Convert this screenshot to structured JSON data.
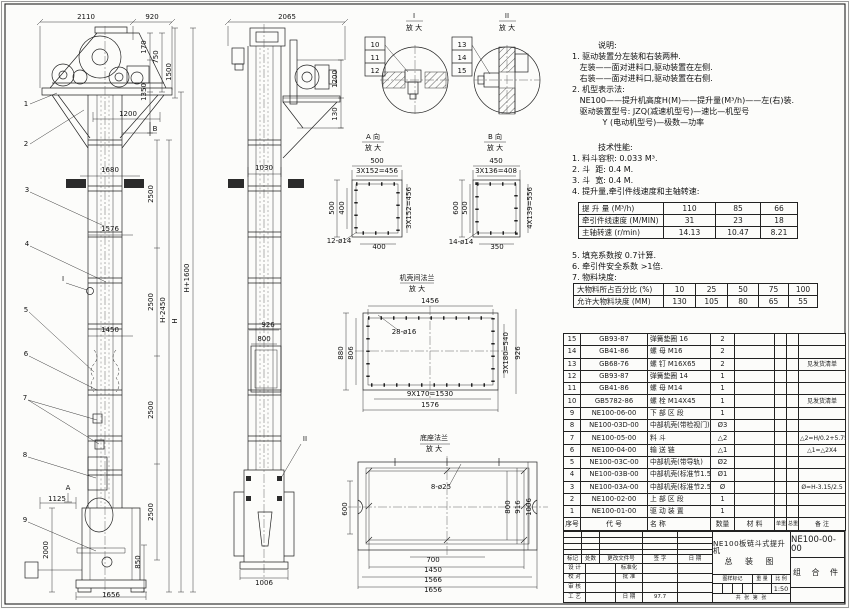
{
  "colors": {
    "paper": "#fcfcfa",
    "ink": "#222222"
  },
  "notes": {
    "heading": "说明:",
    "lines": [
      "1. 驱动装置分左装和右装两种.",
      "   左装——面对进料口,驱动装置在左侧.",
      "   右装——面对进料口,驱动装置在右侧.",
      "2. 机型表示法:",
      "   NE100——提升机高度H(M)——提升量(M³/h)——左(右)装.",
      "   驱动装置型号: JZQ(减速机型号)—速比—机型号",
      "            Y (电动机型号)—极数—功率"
    ]
  },
  "tech": {
    "heading": "技术性能:",
    "lines": [
      "1. 料斗容积: 0.033 M³.",
      "2. 斗  距: 0.4 M.",
      "3. 斗  宽: 0.4 M.",
      "4. 提升量,牵引件线速度和主轴转速:"
    ],
    "table1": [
      [
        "提 升 量 (M³/h)",
        "110",
        "85",
        "66"
      ],
      [
        "牵引件线速度 (M/MIN)",
        "31",
        "23",
        "18"
      ],
      [
        "主轴转速 (r/min)",
        "14.13",
        "10.47",
        "8.21"
      ]
    ],
    "lines2": [
      "5. 填充系数按 0.7计算.",
      "6. 牵引件安全系数 >1倍.",
      "7. 物料块度:"
    ],
    "table2": [
      [
        "大物料所占百分比 (%)",
        "10",
        "25",
        "50",
        "75",
        "100"
      ],
      [
        "允许大物料块度 (MM)",
        "130",
        "105",
        "80",
        "65",
        "55"
      ]
    ]
  },
  "parts": {
    "grid": [
      [
        "15",
        "GB93-87",
        "弹簧垫圈 16",
        "2",
        "",
        "",
        "",
        ""
      ],
      [
        "14",
        "GB41-86",
        "螺 母 M16",
        "2",
        "",
        "",
        "",
        ""
      ],
      [
        "13",
        "GB68-76",
        "螺 钉 M16X65",
        "2",
        "",
        "",
        "",
        "见发货清单"
      ],
      [
        "12",
        "GB93-87",
        "弹簧垫圈 14",
        "1",
        "",
        "",
        "",
        ""
      ],
      [
        "11",
        "GB41-86",
        "螺 母 M14",
        "1",
        "",
        "",
        "",
        ""
      ],
      [
        "10",
        "GB5782-86",
        "螺 栓 M14X45",
        "1",
        "",
        "",
        "",
        "见发货清单"
      ],
      [
        "9",
        "NE100-06-00",
        "下 部 区 段",
        "1",
        "",
        "",
        "",
        ""
      ],
      [
        "8",
        "NE100-03D-00",
        "中部机壳(带检视门)",
        "Ø3",
        "",
        "",
        "",
        ""
      ],
      [
        "7",
        "NE100-05-00",
        "料 斗",
        "△2",
        "",
        "",
        "",
        "△2=H/0.2+5.75"
      ],
      [
        "6",
        "NE100-04-00",
        "输 送 链",
        "△1",
        "",
        "",
        "",
        "△1=△2X4"
      ],
      [
        "5",
        "NE100-03C-00",
        "中部机壳(带导轨)",
        "Ø2",
        "",
        "",
        "",
        ""
      ],
      [
        "4",
        "NE100-03B-00",
        "中部机壳(标准节1.5M,1M)",
        "Ø1",
        "",
        "",
        "",
        ""
      ],
      [
        "3",
        "NE100-03A-00",
        "中部机壳(标准节2.5M)",
        "Ø",
        "",
        "",
        "",
        "Ø=H-3.15/2.5"
      ],
      [
        "2",
        "NE100-02-00",
        "上 部 区 段",
        "1",
        "",
        "",
        "",
        ""
      ],
      [
        "1",
        "NE100-01-00",
        "驱 动 装 置",
        "1",
        "",
        "",
        "",
        ""
      ],
      [
        "序号",
        "代  号",
        "名    称",
        "数量",
        "材  料",
        "单重",
        "总重",
        "备  注"
      ]
    ]
  },
  "tb": {
    "rev": [
      "标记",
      "处数",
      "更改文件号",
      "签 字",
      "日 期"
    ],
    "sign": [
      {
        "a": "设 计",
        "b": "标准化"
      },
      {
        "a": "校 对",
        "b": "批 准"
      },
      {
        "a": "审 核",
        "b": ""
      },
      {
        "a": "工 艺",
        "b": "日 期"
      }
    ],
    "date": "97.7",
    "title1": "NE100板链斗式提升机",
    "title2": "总 装 图",
    "stamp": [
      "图样标记",
      "重 量",
      "比 例"
    ],
    "scale": "1:50",
    "sheetnote": "共  张 第  张",
    "dno": "NE100-00-00",
    "type": "组 合 件"
  },
  "drawing": {
    "labels": [
      {
        "t": "2110",
        "x": 86,
        "y": 19
      },
      {
        "t": "920",
        "x": 152,
        "y": 19
      },
      {
        "t": "170",
        "x": 146,
        "y": 47,
        "r": -90,
        "s": 6
      },
      {
        "t": "750",
        "x": 158,
        "y": 57,
        "r": -90,
        "s": 6
      },
      {
        "t": "1350",
        "x": 146,
        "y": 92,
        "r": -90,
        "s": 6
      },
      {
        "t": "1500",
        "x": 171,
        "y": 72,
        "r": -90,
        "s": 6
      },
      {
        "t": "1200",
        "x": 128,
        "y": 116
      },
      {
        "t": "B",
        "x": 155,
        "y": 131
      },
      {
        "t": "1680",
        "x": 110,
        "y": 172
      },
      {
        "t": "1576",
        "x": 110,
        "y": 231
      },
      {
        "t": "1450",
        "x": 110,
        "y": 332
      },
      {
        "t": "2500",
        "x": 153,
        "y": 194,
        "r": -90,
        "s": 6
      },
      {
        "t": "2500",
        "x": 153,
        "y": 302,
        "r": -90,
        "s": 6
      },
      {
        "t": "2500",
        "x": 153,
        "y": 410,
        "r": -90,
        "s": 6
      },
      {
        "t": "2500",
        "x": 153,
        "y": 512,
        "r": -90,
        "s": 6
      },
      {
        "t": "H-2450",
        "x": 165,
        "y": 310,
        "r": -90,
        "s": 6
      },
      {
        "t": "H",
        "x": 177,
        "y": 321,
        "r": -90,
        "s": 6
      },
      {
        "t": "H+1600",
        "x": 189,
        "y": 278,
        "r": -90,
        "s": 6
      },
      {
        "t": "I",
        "x": 63,
        "y": 281
      },
      {
        "t": "A",
        "x": 68,
        "y": 490,
        "s": 6.5
      },
      {
        "t": "1125",
        "x": 57,
        "y": 501,
        "s": 6.5
      },
      {
        "t": "2000",
        "x": 48,
        "y": 550,
        "r": -90,
        "s": 6
      },
      {
        "t": "850",
        "x": 140,
        "y": 562,
        "r": -90,
        "s": 6
      },
      {
        "t": "1656",
        "x": 111,
        "y": 597
      },
      {
        "t": "1",
        "x": 26,
        "y": 106
      },
      {
        "t": "2",
        "x": 26,
        "y": 146
      },
      {
        "t": "3",
        "x": 27,
        "y": 192
      },
      {
        "t": "4",
        "x": 27,
        "y": 246
      },
      {
        "t": "5",
        "x": 26,
        "y": 312
      },
      {
        "t": "6",
        "x": 26,
        "y": 356
      },
      {
        "t": "7",
        "x": 25,
        "y": 400
      },
      {
        "t": "8",
        "x": 25,
        "y": 457
      },
      {
        "t": "9",
        "x": 25,
        "y": 522
      },
      {
        "t": "2065",
        "x": 287,
        "y": 19
      },
      {
        "t": "1200",
        "x": 337,
        "y": 79,
        "r": -90,
        "s": 6
      },
      {
        "t": "130",
        "x": 337,
        "y": 114,
        "r": -90,
        "s": 6
      },
      {
        "t": "1030",
        "x": 264,
        "y": 170
      },
      {
        "t": "926",
        "x": 268,
        "y": 327,
        "s": 6.5
      },
      {
        "t": "800",
        "x": 264,
        "y": 341,
        "s": 6.5
      },
      {
        "t": "II",
        "x": 305,
        "y": 441
      },
      {
        "t": "1006",
        "x": 264,
        "y": 585
      },
      {
        "t": "I",
        "x": 414,
        "y": 18
      },
      {
        "t": "放 大",
        "x": 414,
        "y": 30,
        "s": 6.5
      },
      {
        "t": "II",
        "x": 507,
        "y": 18
      },
      {
        "t": "放 大",
        "x": 507,
        "y": 30,
        "s": 6.5
      },
      {
        "t": "10",
        "x": 375,
        "y": 47,
        "s": 6.5
      },
      {
        "t": "11",
        "x": 375,
        "y": 60,
        "s": 6.5
      },
      {
        "t": "12",
        "x": 375,
        "y": 73,
        "s": 6.5
      },
      {
        "t": "13",
        "x": 462,
        "y": 47,
        "s": 6.5
      },
      {
        "t": "14",
        "x": 462,
        "y": 60,
        "s": 6.5
      },
      {
        "t": "15",
        "x": 462,
        "y": 73,
        "s": 6.5
      },
      {
        "t": "A 向",
        "x": 373,
        "y": 139,
        "s": 6.5
      },
      {
        "t": "放 大",
        "x": 373,
        "y": 150,
        "s": 6.5
      },
      {
        "t": "500",
        "x": 377,
        "y": 163,
        "s": 6.5
      },
      {
        "t": "3X152=456",
        "x": 377,
        "y": 173,
        "s": 5.5
      },
      {
        "t": "500",
        "x": 334,
        "y": 208,
        "r": -90,
        "s": 6
      },
      {
        "t": "400",
        "x": 344,
        "y": 208,
        "r": -90,
        "s": 6
      },
      {
        "t": "3X152=456",
        "x": 411,
        "y": 208,
        "r": -90,
        "s": 5.5
      },
      {
        "t": "12-ø14",
        "x": 339,
        "y": 243,
        "s": 6
      },
      {
        "t": "400",
        "x": 379,
        "y": 249,
        "s": 6.5
      },
      {
        "t": "B 向",
        "x": 495,
        "y": 139,
        "s": 6.5
      },
      {
        "t": "放 大",
        "x": 495,
        "y": 150,
        "s": 6.5
      },
      {
        "t": "450",
        "x": 496,
        "y": 163,
        "s": 6.5
      },
      {
        "t": "3X136=408",
        "x": 496,
        "y": 173,
        "s": 5.5
      },
      {
        "t": "600",
        "x": 458,
        "y": 208,
        "r": -90,
        "s": 6
      },
      {
        "t": "500",
        "x": 467,
        "y": 208,
        "r": -90,
        "s": 6
      },
      {
        "t": "4X139=556",
        "x": 532,
        "y": 208,
        "r": -90,
        "s": 5.5
      },
      {
        "t": "14-ø14",
        "x": 461,
        "y": 244,
        "s": 6
      },
      {
        "t": "350",
        "x": 497,
        "y": 249,
        "s": 6.5
      },
      {
        "t": "机壳间法兰",
        "x": 417,
        "y": 280,
        "s": 6.5
      },
      {
        "t": "放 大",
        "x": 417,
        "y": 291,
        "s": 6.5
      },
      {
        "t": "1456",
        "x": 430,
        "y": 303
      },
      {
        "t": "28-ø16",
        "x": 404,
        "y": 334,
        "s": 6
      },
      {
        "t": "880",
        "x": 343,
        "y": 353,
        "r": -90,
        "s": 6
      },
      {
        "t": "806",
        "x": 353,
        "y": 353,
        "r": -90,
        "s": 6
      },
      {
        "t": "3X180=540",
        "x": 508,
        "y": 353,
        "r": -90,
        "s": 5.5
      },
      {
        "t": "926",
        "x": 520,
        "y": 353,
        "r": -90,
        "s": 6
      },
      {
        "t": "9X170=1530",
        "x": 430,
        "y": 396,
        "s": 6
      },
      {
        "t": "1576",
        "x": 430,
        "y": 407
      },
      {
        "t": "底座法兰",
        "x": 434,
        "y": 440,
        "s": 6.5
      },
      {
        "t": "放 大",
        "x": 434,
        "y": 451,
        "s": 6.5
      },
      {
        "t": "8-ø25",
        "x": 441,
        "y": 489,
        "s": 6
      },
      {
        "t": "600",
        "x": 347,
        "y": 509,
        "r": -90,
        "s": 6
      },
      {
        "t": "800",
        "x": 510,
        "y": 507,
        "r": -90,
        "s": 6
      },
      {
        "t": "916",
        "x": 520,
        "y": 507,
        "r": -90,
        "s": 6
      },
      {
        "t": "1006",
        "x": 531,
        "y": 507,
        "r": -90,
        "s": 6
      },
      {
        "t": "700",
        "x": 433,
        "y": 562,
        "s": 6.5
      },
      {
        "t": "1450",
        "x": 433,
        "y": 572,
        "s": 6.5
      },
      {
        "t": "1566",
        "x": 433,
        "y": 582,
        "s": 6.5
      },
      {
        "t": "1656",
        "x": 433,
        "y": 592,
        "s": 6.5
      }
    ]
  }
}
